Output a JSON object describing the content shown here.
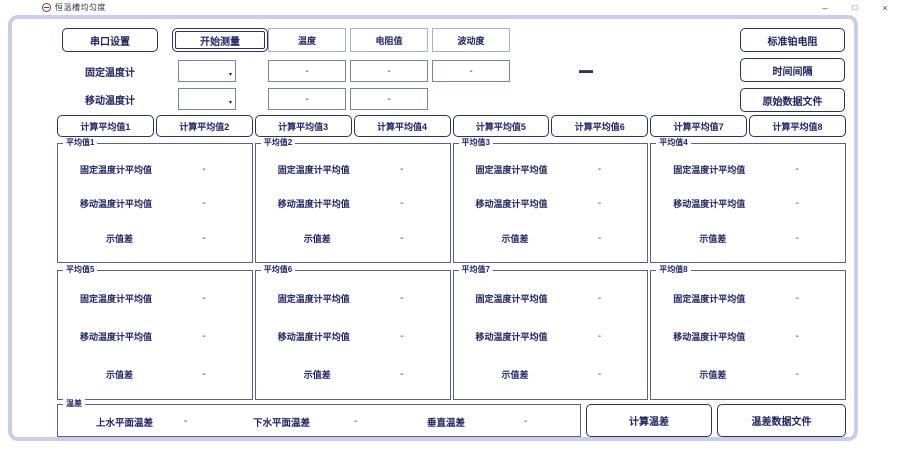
{
  "window": {
    "title": "恒温槽均匀度",
    "controls": {
      "minimize": "–",
      "maximize": "□",
      "close": "×"
    }
  },
  "colors": {
    "accent_navy": "#2b2f6e",
    "text_navy": "#1f2465",
    "panel_frame": "#c9cdea"
  },
  "toolbar": {
    "serial_button": "串口设置",
    "start_button": "开始测量",
    "column_headers": [
      "温度",
      "电阻值",
      "波动度"
    ],
    "right_buttons": [
      "标准铂电阻",
      "时间间隔",
      "原始数据文件"
    ]
  },
  "sensors": {
    "fixed": {
      "label": "固定温度计",
      "dropdown_value": "",
      "values": [
        "-",
        "-",
        "-"
      ]
    },
    "mobile": {
      "label": "移动温度计",
      "dropdown_value": "",
      "values": [
        "-",
        "-"
      ]
    }
  },
  "average_buttons": [
    "计算平均值1",
    "计算平均值2",
    "计算平均值3",
    "计算平均值4",
    "计算平均值5",
    "计算平均值6",
    "计算平均值7",
    "计算平均值8"
  ],
  "average_groups": [
    {
      "title": "平均值1",
      "rows": [
        {
          "label": "固定温度计平均值",
          "value": "-"
        },
        {
          "label": "移动温度计平均值",
          "value": "-"
        },
        {
          "label": "示值差",
          "value": "-"
        }
      ]
    },
    {
      "title": "平均值2",
      "rows": [
        {
          "label": "固定温度计平均值",
          "value": "-"
        },
        {
          "label": "移动温度计平均值",
          "value": "-"
        },
        {
          "label": "示值差",
          "value": "-"
        }
      ]
    },
    {
      "title": "平均值3",
      "rows": [
        {
          "label": "固定温度计平均值",
          "value": "-"
        },
        {
          "label": "移动温度计平均值",
          "value": "-"
        },
        {
          "label": "示值差",
          "value": "-"
        }
      ]
    },
    {
      "title": "平均值4",
      "rows": [
        {
          "label": "固定温度计平均值",
          "value": "-"
        },
        {
          "label": "移动温度计平均值",
          "value": "-"
        },
        {
          "label": "示值差",
          "value": "-"
        }
      ]
    },
    {
      "title": "平均值5",
      "rows": [
        {
          "label": "固定温度计平均值",
          "value": "-"
        },
        {
          "label": "移动温度计平均值",
          "value": "-"
        },
        {
          "label": "示值差",
          "value": "-"
        }
      ]
    },
    {
      "title": "平均值6",
      "rows": [
        {
          "label": "固定温度计平均值",
          "value": "-"
        },
        {
          "label": "移动温度计平均值",
          "value": "-"
        },
        {
          "label": "示值差",
          "value": "-"
        }
      ]
    },
    {
      "title": "平均值7",
      "rows": [
        {
          "label": "固定温度计平均值",
          "value": "-"
        },
        {
          "label": "移动温度计平均值",
          "value": "-"
        },
        {
          "label": "示值差",
          "value": "-"
        }
      ]
    },
    {
      "title": "平均值8",
      "rows": [
        {
          "label": "固定温度计平均值",
          "value": "-"
        },
        {
          "label": "移动温度计平均值",
          "value": "-"
        },
        {
          "label": "示值差",
          "value": "-"
        }
      ]
    }
  ],
  "temp_diff": {
    "title": "温差",
    "items": [
      {
        "label": "上水平面温差",
        "value": "-"
      },
      {
        "label": "下水平面温差",
        "value": "-"
      },
      {
        "label": "垂直温差",
        "value": "-"
      }
    ],
    "calc_button": "计算温差",
    "file_button": "温差数据文件"
  }
}
